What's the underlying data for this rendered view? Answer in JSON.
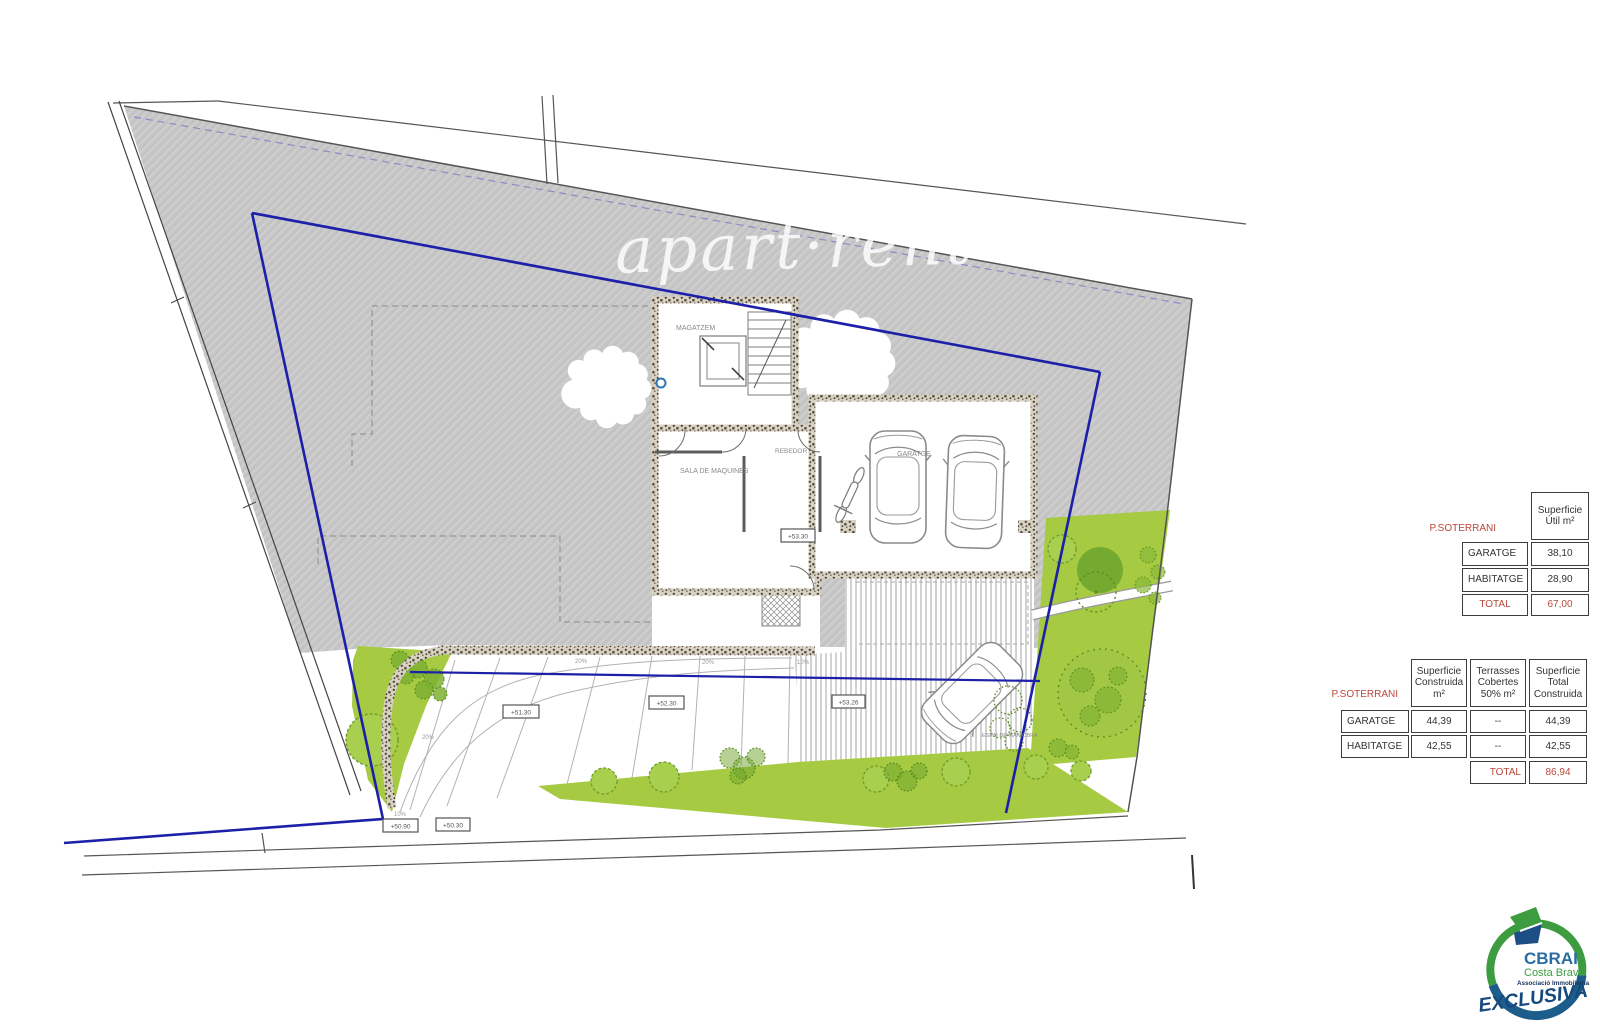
{
  "watermark": {
    "text": "apart·rent"
  },
  "plan": {
    "rooms": {
      "magatzem": "MAGATZEM",
      "sala_de_maquines": "SALA DE MAQUINES",
      "rebedor": "REBEDOR",
      "garatge": "GARATGE",
      "espai_de_maniobra": "ESPAI DE MANIOBRA"
    },
    "levels": {
      "building": "+53.30",
      "terrace_1": "+51.30",
      "terrace_2": "+52.30",
      "terrace_3": "+53.26",
      "street_1": "+50.90",
      "street_2": "+50.30"
    },
    "slopes": {
      "terrace_a": "20%",
      "terrace_b": "20%",
      "terrace_c": "10%",
      "ramp_mid": "20%",
      "ramp_left": "10%"
    }
  },
  "tables": {
    "superficie_util": {
      "section_label": "P.SOTERRANI",
      "col_header": "Superficie Útil m²",
      "rows": [
        {
          "label": "GARATGE",
          "value": "38,10"
        },
        {
          "label": "HABITATGE",
          "value": "28,90"
        }
      ],
      "total_label": "TOTAL",
      "total_value": "67,00"
    },
    "superficie_construida": {
      "section_label": "P.SOTERRANI",
      "col_headers": [
        "Superficie Construida m²",
        "Terrasses Cobertes 50% m²",
        "Superficie Total Construida"
      ],
      "rows": [
        {
          "label": "GARATGE",
          "constructed": "44,39",
          "terraces": "--",
          "total": "44,39"
        },
        {
          "label": "HABITATGE",
          "constructed": "42,55",
          "terraces": "--",
          "total": "42,55"
        }
      ],
      "total_label": "TOTAL",
      "total_value": "86,94"
    }
  },
  "logo": {
    "brand": "CBRAI",
    "region": "Costa Brava",
    "association": "Associació Immobiliària",
    "badge": "EXCLUSIVA"
  },
  "colors": {
    "boundary_blue": "#1c20a8",
    "accent_red": "#b8473a",
    "grass_green": "#a6ca42"
  }
}
